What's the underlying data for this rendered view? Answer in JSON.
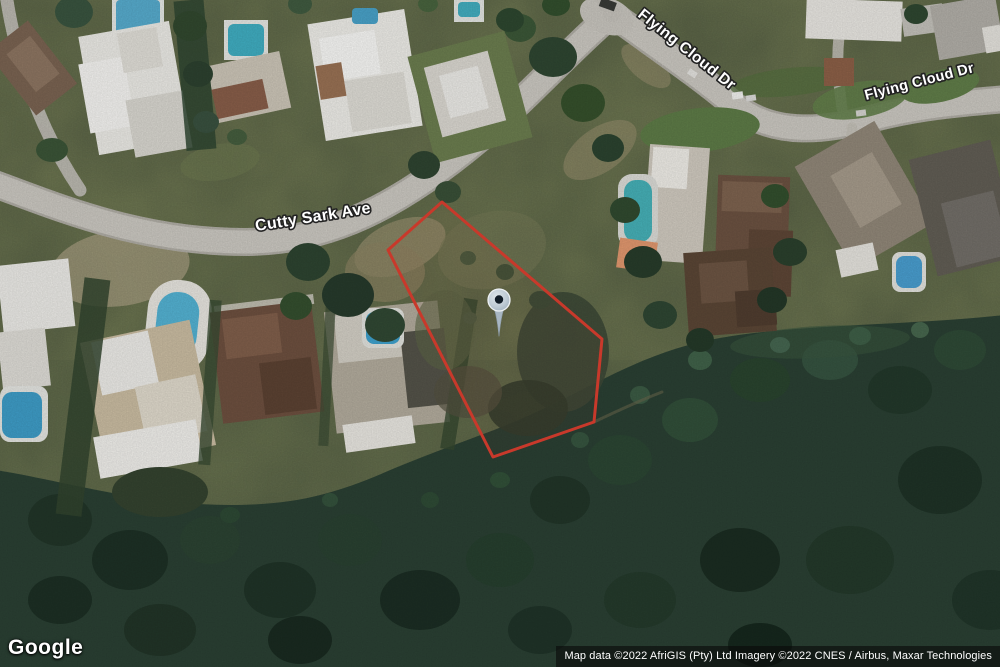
{
  "map": {
    "type": "satellite",
    "street_labels": {
      "cutty_sark": "Cutty Sark Ave",
      "flying_cloud_upper": "Flying Cloud Dr",
      "flying_cloud_right": "Flying Cloud Dr"
    },
    "marker": {
      "icon": "location-pin-icon",
      "fill_color": "#b4c2cd",
      "dot_color": "#111c27"
    },
    "property_boundary": {
      "shape": "polygon",
      "color": "#c8392b"
    }
  },
  "branding": {
    "logo_text": "Google"
  },
  "attribution": {
    "text": "Map data ©2022 AfriGIS (Pty) Ltd Imagery ©2022 CNES / Airbus, Maxar Technologies"
  }
}
